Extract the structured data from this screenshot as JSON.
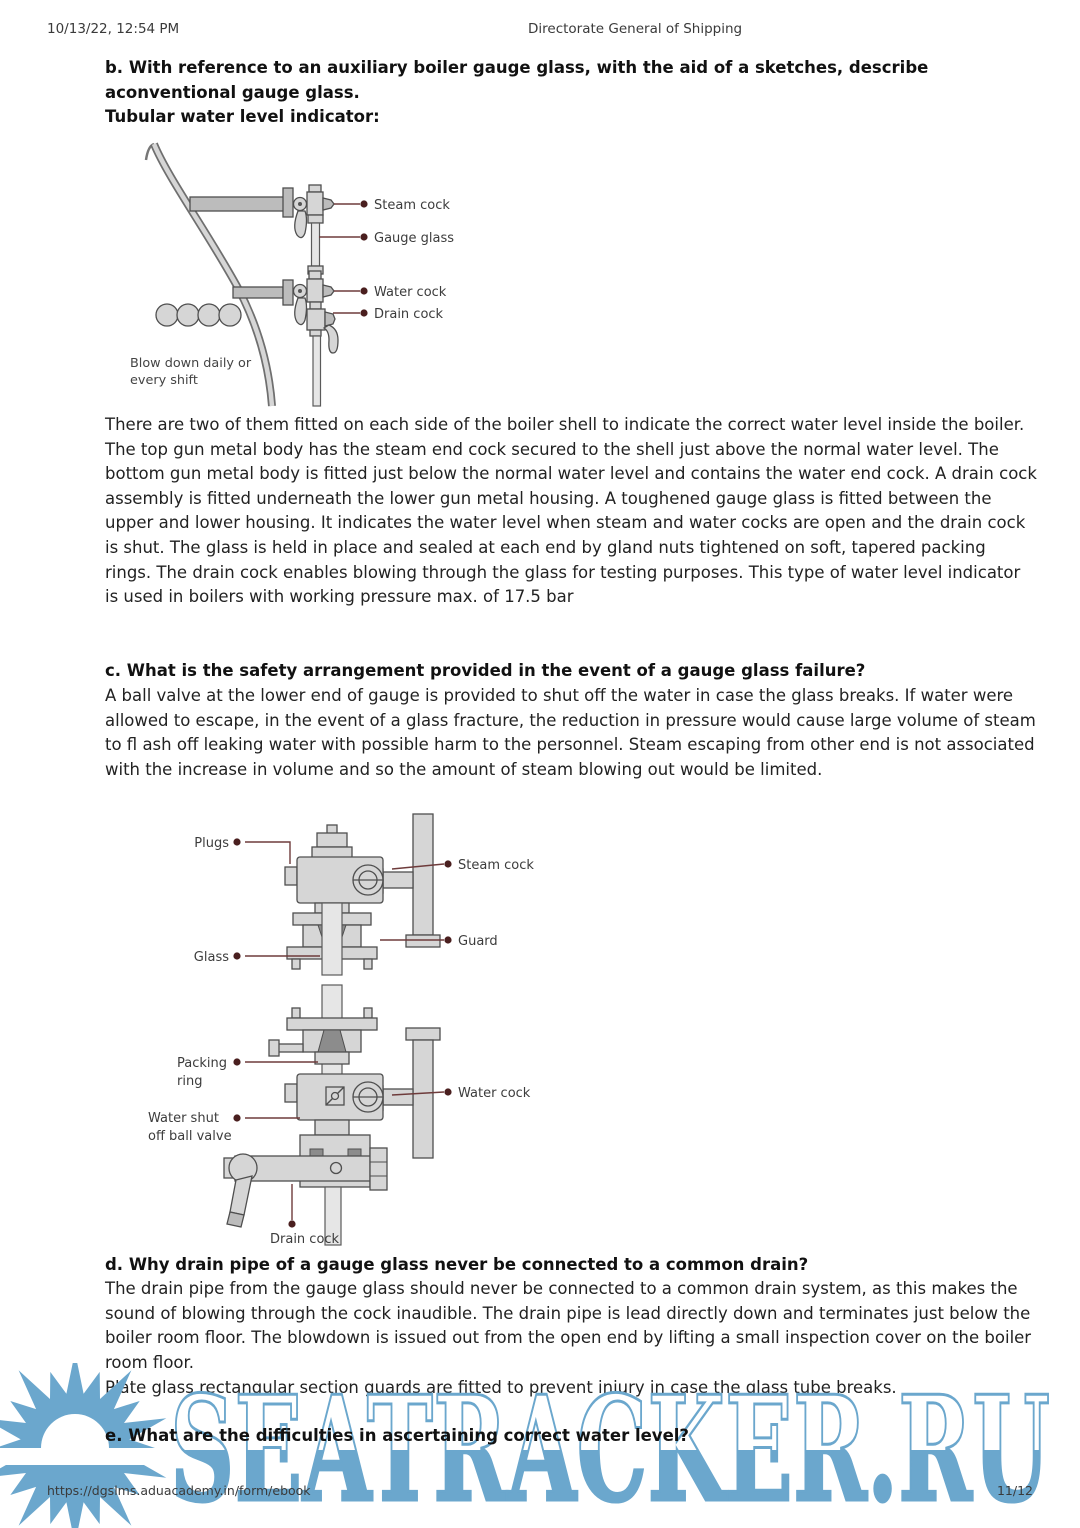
{
  "header": {
    "datetime": "10/13/22, 12:54 PM",
    "title": "Directorate General of Shipping"
  },
  "sections": {
    "b": {
      "heading": "b. With reference to an auxiliary boiler gauge glass, with the aid of a sketches, describe aconventional gauge glass.",
      "subheading": "Tubular water level indicator:",
      "body": "There are two of them fitted on each side of the boiler shell to indicate the correct water level inside the boiler. The top gun metal body has the steam end cock secured to the shell just above the normal water level. The bottom gun metal body is fitted just below the normal water level and contains the water end cock. A drain cock assembly is fitted underneath the lower gun metal housing. A toughened gauge glass is fitted between the upper and lower housing. It indicates the water level when steam and water cocks are open and the drain cock is shut. The glass is held in place and sealed at each end by gland nuts tightened on soft, tapered packing rings. The drain cock enables blowing through the glass for testing purposes. This type of water level indicator is used in boilers with working pressure max. of 17.5 bar"
    },
    "c": {
      "heading": "c. What is the safety arrangement provided in the event of a gauge glass failure?",
      "body": "A ball valve at the lower end of gauge is provided to shut off the water in case the glass breaks. If water were allowed to escape, in the event of a glass fracture, the reduction in pressure would cause large volume of steam to fl ash off leaking water with possible harm to the personnel. Steam escaping from other end is not associated with the increase in volume and so the amount of steam blowing out would be limited."
    },
    "d": {
      "heading": "d. Why drain pipe of a gauge glass never be connected to a common drain?",
      "body": "The drain pipe from the gauge glass should never be connected to a common drain system, as this makes the sound of blowing through the cock inaudible. The drain pipe is lead directly down and terminates just below the boiler room floor. The blowdown is issued out from the open end by lifting a small inspection cover on the boiler room floor.",
      "note": "Plate glass rectangular section guards are fitted to prevent injury in case the glass tube breaks."
    },
    "e": {
      "heading": "e. What are the difficulties in ascertaining correct water level?"
    }
  },
  "figure1": {
    "labels": {
      "steam_cock": "Steam cock",
      "gauge_glass": "Gauge glass",
      "water_cock": "Water cock",
      "drain_cock": "Drain cock"
    },
    "caption_line1": "Blow down daily or",
    "caption_line2": "every shift"
  },
  "figure2": {
    "labels": {
      "plugs": "Plugs",
      "steam_cock": "Steam cock",
      "guard": "Guard",
      "glass": "Glass",
      "packing_line1": "Packing",
      "packing_line2": "ring",
      "water_cock": "Water cock",
      "water_shut_line1": "Water shut",
      "water_shut_line2": "off ball valve",
      "drain_cock": "Drain cock"
    }
  },
  "watermark": {
    "text": "SEATRACKER.RU",
    "color": "#6ba7cd"
  },
  "footer": {
    "url": "https://dgslms.aduacademy.in/form/ebook",
    "page": "11/12"
  }
}
